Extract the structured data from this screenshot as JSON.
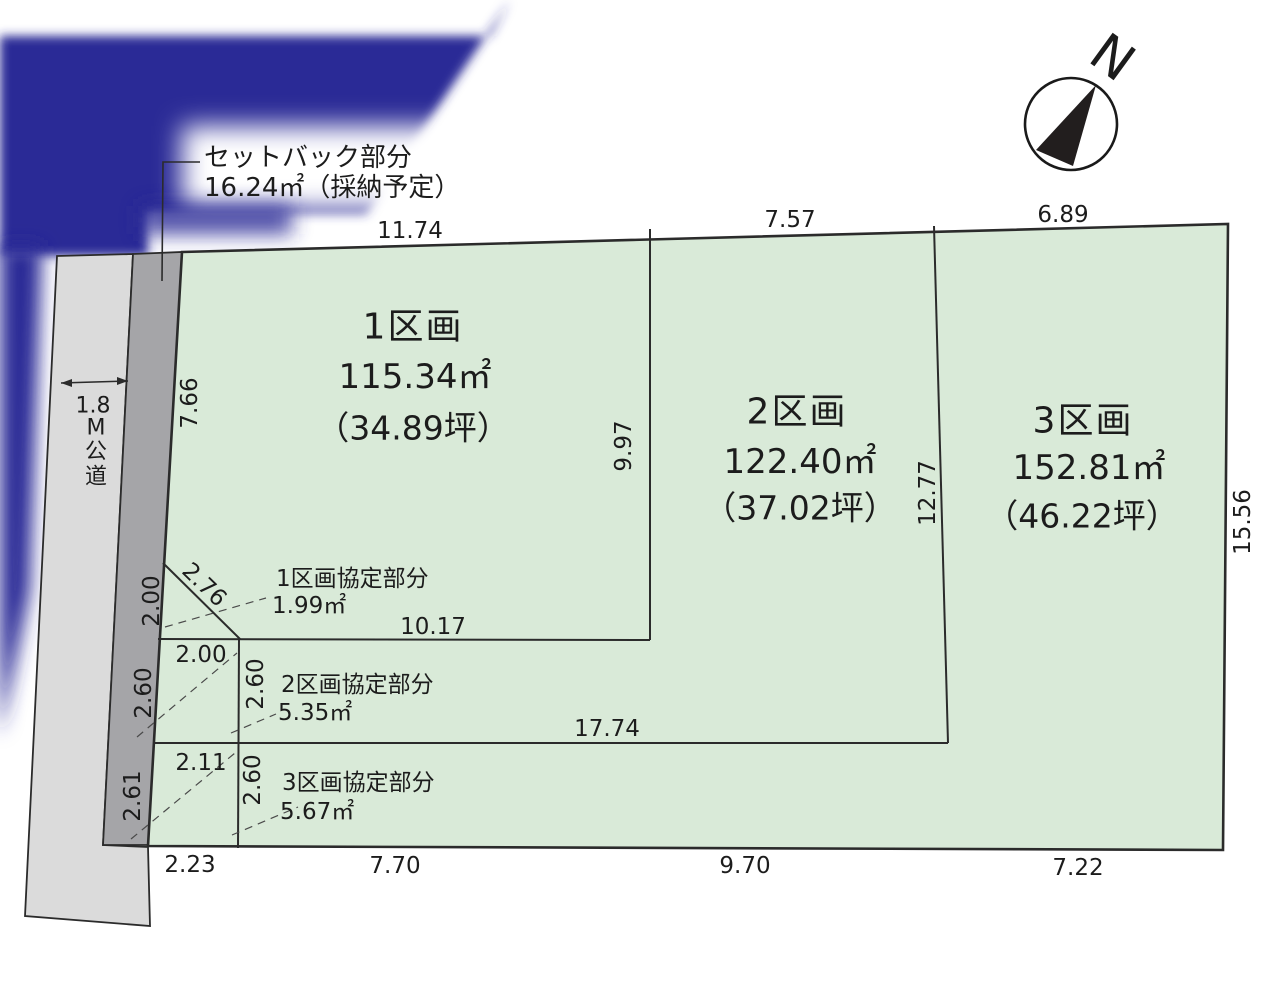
{
  "compass": {
    "label": "N"
  },
  "setback_note": {
    "line1": "セットバック部分",
    "line2": "16.24㎡（採納予定）"
  },
  "road": {
    "width": "1.8",
    "name_chars": [
      "M",
      "公",
      "道"
    ]
  },
  "parcels": [
    {
      "name": "1区画",
      "area_m2": "115.34㎡",
      "area_tsubo": "（34.89坪）"
    },
    {
      "name": "2区画",
      "area_m2": "122.40㎡",
      "area_tsubo": "（37.02坪）"
    },
    {
      "name": "3区画",
      "area_m2": "152.81㎡",
      "area_tsubo": "（46.22坪）"
    }
  ],
  "agreement_notes": [
    {
      "label": "1区画協定部分",
      "area": "1.99㎡"
    },
    {
      "label": "2区画協定部分",
      "area": "5.35㎡"
    },
    {
      "label": "3区画協定部分",
      "area": "5.67㎡"
    }
  ],
  "dims": {
    "top": [
      "11.74",
      "7.57",
      "6.89"
    ],
    "right": "15.56",
    "bottom": [
      "2.23",
      "7.70",
      "9.70",
      "7.22"
    ],
    "parcel1_left": "7.66",
    "parcel1_right": "9.97",
    "parcel1_bottom": "10.17",
    "parcel2_right": "12.77",
    "parcel2_bottom": "17.74",
    "diagonal": "2.76",
    "strip": [
      "2.00",
      "2.60",
      "2.61"
    ],
    "cells": {
      "row1_w": "2.00",
      "row1_h": "2.60",
      "row2_w": "2.11",
      "row2_h": "2.60"
    }
  },
  "colors": {
    "parcel_fill": "#d9ead8",
    "road_fill": "#dbdbdb",
    "setback_strip_fill": "#a5a5a8",
    "overlay_blue": "#2c2c96",
    "line": "#2b2b2b"
  }
}
